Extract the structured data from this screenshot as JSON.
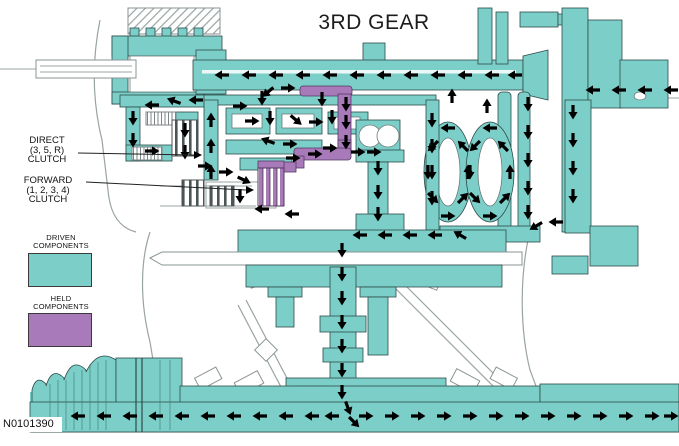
{
  "title": "3RD GEAR",
  "figure_id": "N0101390",
  "callouts": {
    "direct": "DIRECT\n(3, 5, R)\nCLUTCH",
    "forward": "FORWARD\n(1, 2, 3, 4)\nCLUTCH"
  },
  "legend": {
    "driven": {
      "label": "DRIVEN\nCOMPONENTS",
      "color": "#7CCFC9"
    },
    "held": {
      "label": "HELD\nCOMPONENTS",
      "color": "#A87ABA"
    }
  },
  "diagram": {
    "flow_arrow_color": "#000000"
  }
}
